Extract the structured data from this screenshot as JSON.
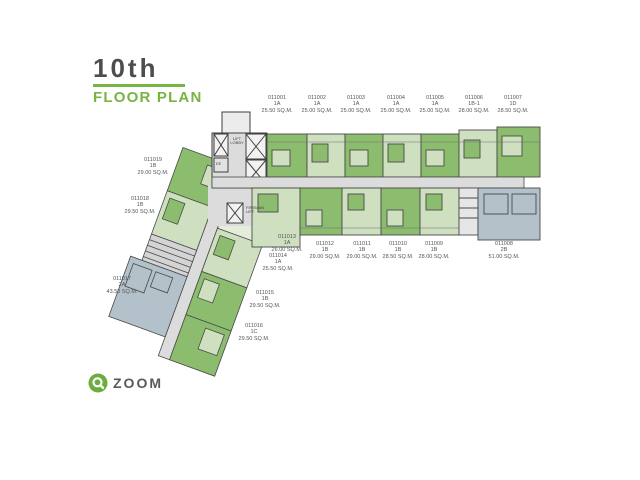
{
  "header": {
    "floor_title": "10th",
    "subtitle": "FLOOR PLAN"
  },
  "logo": {
    "brand": "ZOOM"
  },
  "plan": {
    "annotations": {
      "lift_lobby": "LIFT\nLOBBY",
      "fireman_lift": "FIREMAN\nLIFT",
      "ee": "EE"
    },
    "colors": {
      "unit_green": "#8cbd6e",
      "unit_green_light": "#cfe0c1",
      "unit_green_pale": "#e4edd9",
      "unit_gray_blue": "#b2c1ca",
      "corridor": "#dcdcdc",
      "core": "#d4d4d4",
      "service": "#e6e6e6",
      "lift": "#f2f2f2",
      "accent_green": "#77b443",
      "logo_green": "#6cae3e",
      "title_gray": "#4d4d4f"
    },
    "units": [
      {
        "id": "011001",
        "type": "1A",
        "area": "25.50 SQ.M."
      },
      {
        "id": "011002",
        "type": "1A",
        "area": "25.00 SQ.M."
      },
      {
        "id": "011003",
        "type": "1A",
        "area": "25.00 SQ.M."
      },
      {
        "id": "011004",
        "type": "1A",
        "area": "25.00 SQ.M."
      },
      {
        "id": "011005",
        "type": "1A",
        "area": "25.00 SQ.M."
      },
      {
        "id": "011006",
        "type": "1B-1",
        "area": "28.00 SQ.M."
      },
      {
        "id": "011007",
        "type": "1D",
        "area": "28.50 SQ.M."
      },
      {
        "id": "011008",
        "type": "2B",
        "area": "51.00 SQ.M."
      },
      {
        "id": "011009",
        "type": "1B",
        "area": "28.00 SQ.M."
      },
      {
        "id": "011010",
        "type": "1B",
        "area": "28.50 SQ.M."
      },
      {
        "id": "011011",
        "type": "1B",
        "area": "29.00 SQ.M."
      },
      {
        "id": "011012",
        "type": "1B",
        "area": "29.00 SQ.M."
      },
      {
        "id": "011013",
        "type": "1A",
        "area": "26.00 SQ.M."
      },
      {
        "id": "011014",
        "type": "1A",
        "area": "25.50 SQ.M."
      },
      {
        "id": "011015",
        "type": "1B",
        "area": "29.50 SQ.M."
      },
      {
        "id": "011016",
        "type": "1C",
        "area": "29.50 SQ.M."
      },
      {
        "id": "011017",
        "type": "2A",
        "area": "43.50 SQ.M."
      },
      {
        "id": "011018",
        "type": "1B",
        "area": "29.50 SQ.M."
      },
      {
        "id": "011019",
        "type": "1B",
        "area": "29.00 SQ.M."
      }
    ]
  }
}
